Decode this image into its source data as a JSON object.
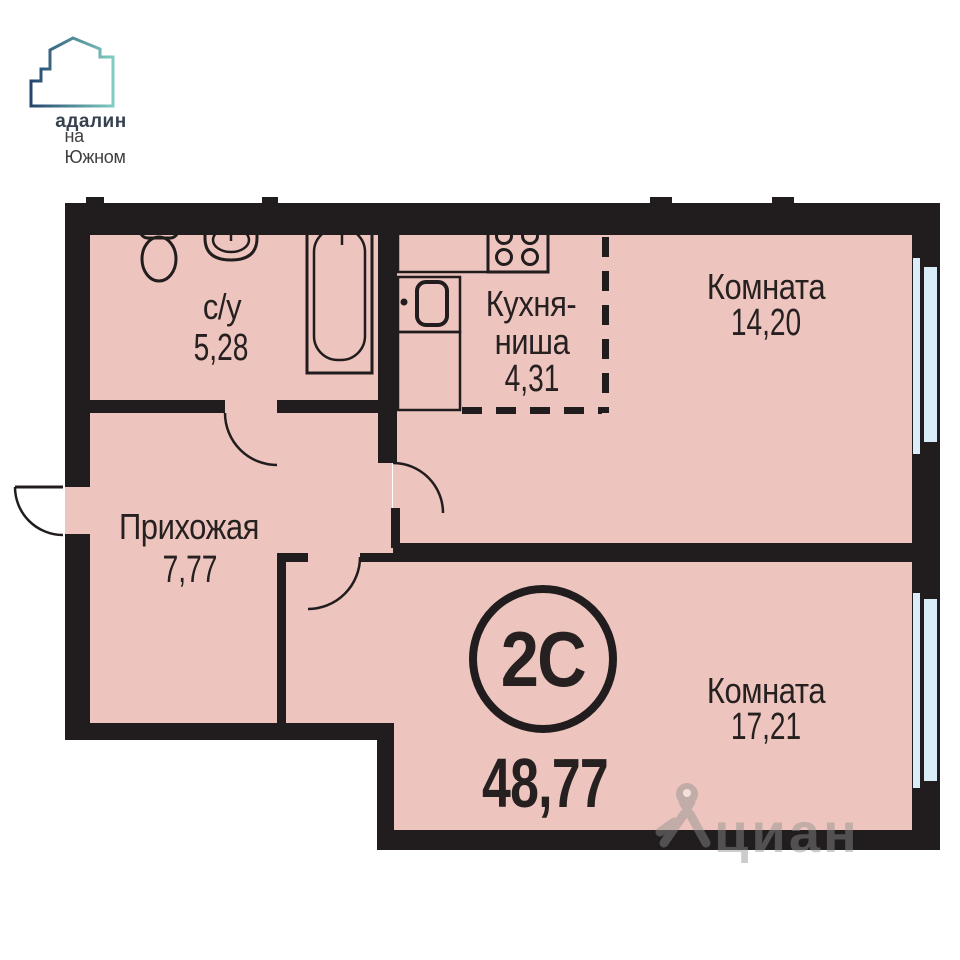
{
  "logo": {
    "brand": "адалин",
    "location": "на Южном"
  },
  "apartment": {
    "type_badge": "2С",
    "total_area": "48,77",
    "rooms": [
      {
        "name": "с/у",
        "area": "5,28"
      },
      {
        "name": "Кухня-ниша",
        "name_line1": "Кухня-",
        "name_line2": "ниша",
        "area": "4,31"
      },
      {
        "name": "Комната",
        "area": "14,20"
      },
      {
        "name": "Прихожая",
        "area": "7,77"
      },
      {
        "name": "Комната",
        "area": "17,21"
      }
    ]
  },
  "watermark": {
    "text": "циан"
  },
  "colors": {
    "wall": "#211c1d",
    "room": "#edc5be",
    "window": "#d9edf8",
    "ink": "#262021",
    "logo_navy": "#24466e",
    "logo_teal": "#7fccc1",
    "logo_text": "#35414f",
    "wm": "#8f8f8f"
  }
}
